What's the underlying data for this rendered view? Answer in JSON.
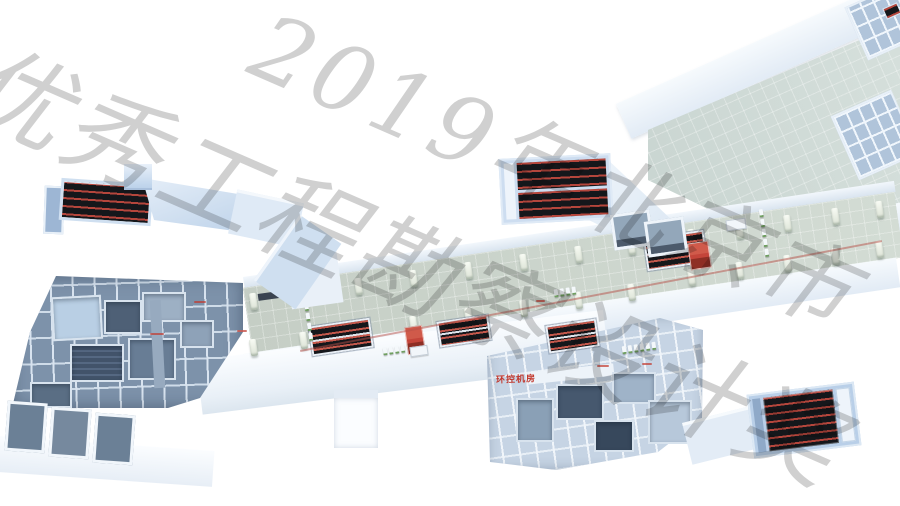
{
  "watermark": {
    "line1": "2019年北京市",
    "line2": "优秀工程勘察设计奖"
  },
  "room_labels": {
    "env_control": "环控机房"
  },
  "palette": {
    "bg": "#ffffff",
    "watermark-gray": "#d0d0d0",
    "model-light": "#d9e6f5",
    "model-mid": "#bdd2ea",
    "model-deep": "#9db6d4",
    "roof-white": "#f6fafd",
    "wall-face": "#7d92aa",
    "wall-line": "#d9e4f0",
    "wall-dark": "#4e6078",
    "floor-green": "#cbd4ca",
    "floor-teal": "#cdd9d4",
    "esc-dark": "#15171b",
    "esc-red": "#b5463c",
    "elevator-red": "#c4453a",
    "elevator-red-dark": "#8e2e24",
    "gate-green": "#6f9f60",
    "label-red": "#c2392e",
    "line-red": "#b65048"
  }
}
